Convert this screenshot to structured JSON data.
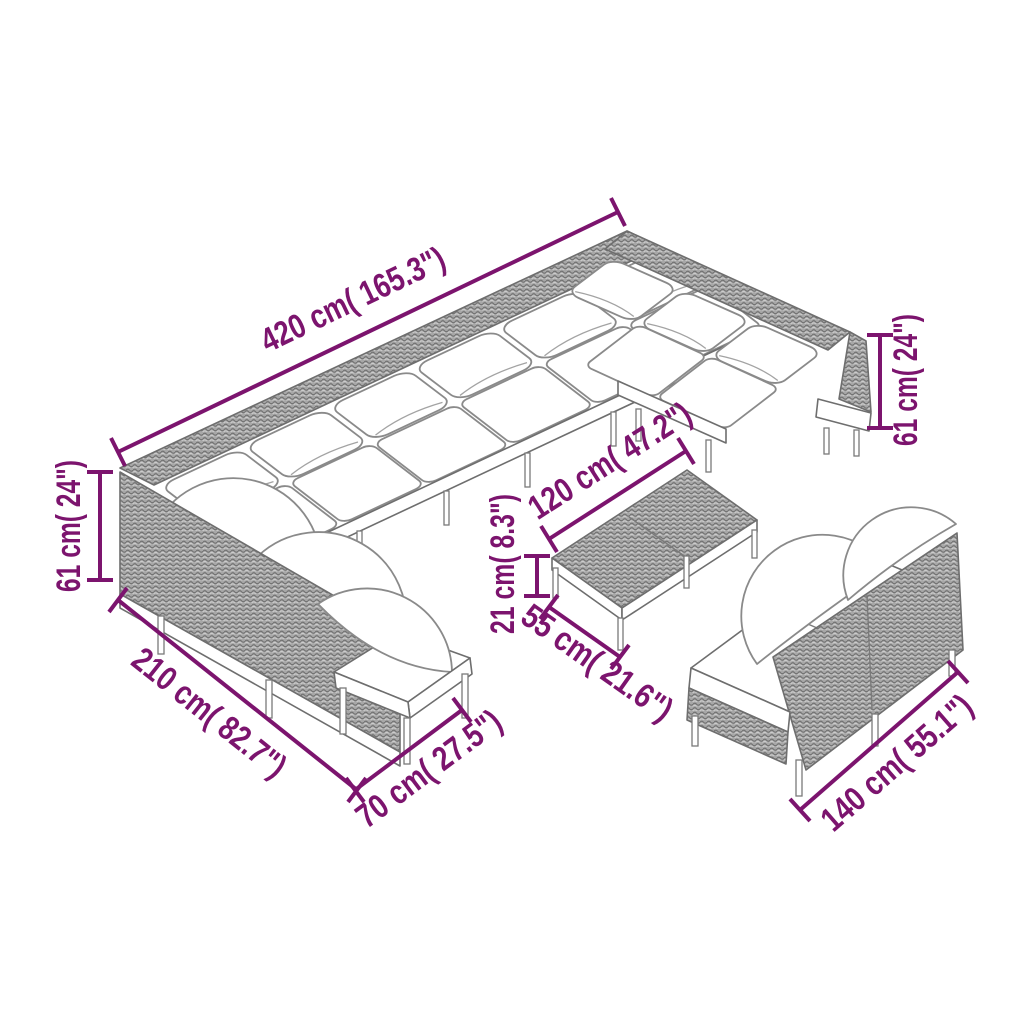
{
  "colors": {
    "accent": "#7c146e",
    "artwork_line": "#6e6e6e",
    "rattan_fill": "#a8a8a8",
    "cushion_fill": "#ffffff",
    "background": "#ffffff"
  },
  "dimensions": {
    "sofa_total_length": "420 cm( 165.3\")",
    "back_height_right": "61 cm( 24\")",
    "back_height_left": "61 cm( 24\")",
    "left_wing_length": "210 cm( 82.7\")",
    "module_depth": "70 cm( 27.5\")",
    "table_length": "120 cm( 47.2\")",
    "table_height": "21 cm( 8.3\")",
    "table_depth": "55 cm( 21.6\")",
    "two_seater_length": "140 cm( 55.1\")"
  }
}
